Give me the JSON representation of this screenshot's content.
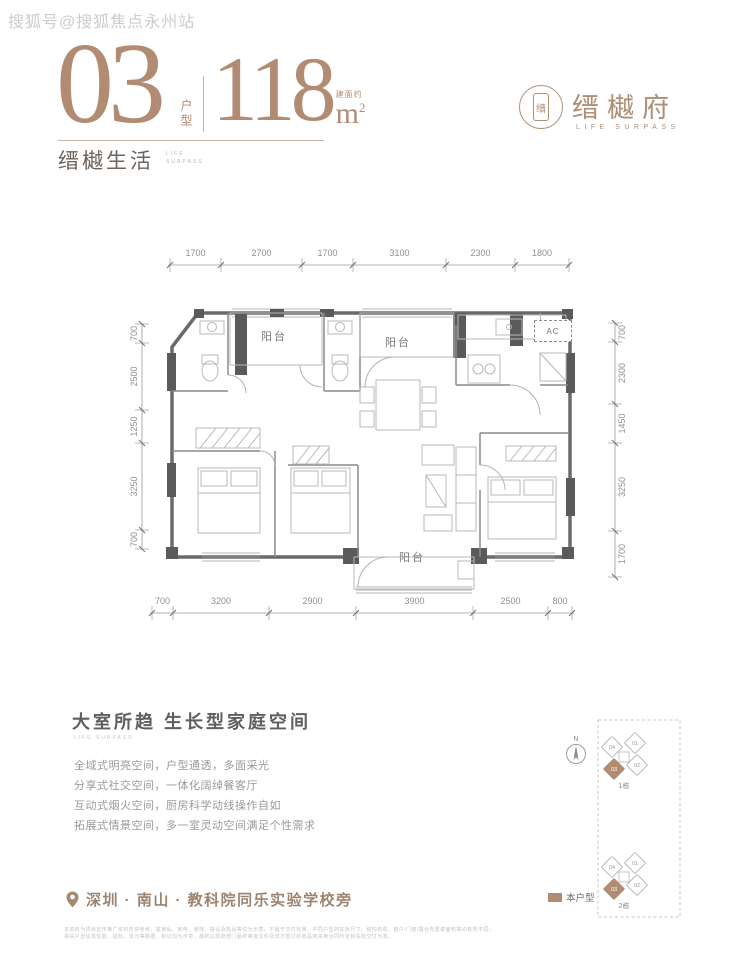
{
  "watermark": "搜狐号@搜狐焦点永州站",
  "header": {
    "unit_number": "03",
    "unit_label": "户型",
    "area_value": "118",
    "area_prefix": "建面约",
    "area_unit": "m",
    "area_sup": "2",
    "slogan": "缙樾生活",
    "slogan_sub_1": "LIFE",
    "slogan_sub_2": "SURPASS"
  },
  "brand": {
    "seal_char": "缙",
    "name": "缙樾府",
    "tagline": "LIFE SURPASS"
  },
  "floorplan": {
    "dims_top": [
      "1700",
      "2700",
      "1700",
      "3100",
      "2300",
      "1800"
    ],
    "dims_bottom": [
      "700",
      "3200",
      "2900",
      "3900",
      "2500",
      "800"
    ],
    "dims_left": [
      "700",
      "2500",
      "1250",
      "3250",
      "700"
    ],
    "dims_right": [
      "700",
      "2300",
      "1450",
      "3250",
      "1700"
    ],
    "labels": {
      "balcony_top_left": "阳台",
      "balcony_top_middle": "阳台",
      "balcony_bottom": "阳台",
      "ac": "AC"
    }
  },
  "features": {
    "title": "大室所趋 生长型家庭空间",
    "subtitle": "LIFE SURPASS",
    "bullets": [
      "全域式明亮空间，户型通透，多面采光",
      "分享式社交空间，一体化阔绰餐客厅",
      "互动式烟火空间，厨房科学动线操作自如",
      "拓展式情景空间，多一室灵动空间满足个性需求"
    ]
  },
  "location": {
    "text": "深圳 · 南山 · 教科院同乐实验学校旁"
  },
  "siteplan": {
    "compass": "N",
    "buildings": [
      {
        "label": "1栋",
        "units": [
          "04",
          "01",
          "03",
          "02"
        ],
        "highlight": "03"
      },
      {
        "label": "2栋",
        "units": [
          "04",
          "01",
          "03",
          "02"
        ],
        "highlight": "03"
      }
    ],
    "legend": "本户型"
  },
  "disclaimer": [
    "本资料为项目宣传推广资料仅供参考，其家私、家电、装饰、摆设及陈设等仅为示意，不属于交付标准，不同户型的实际尺寸、结构布局、窗户/门窗/露台布置或面积等均有所不同；",
    "相关户型信息性能、指标、单元等数据、标识均为示意，最终以政府部门最终审批文件及双方签订的商品房买卖合同约定和实际交付为准。"
  ],
  "colors": {
    "accent": "#b28b73",
    "plan_wall": "#5a5a5a",
    "dim_text": "#8f8f8f"
  }
}
